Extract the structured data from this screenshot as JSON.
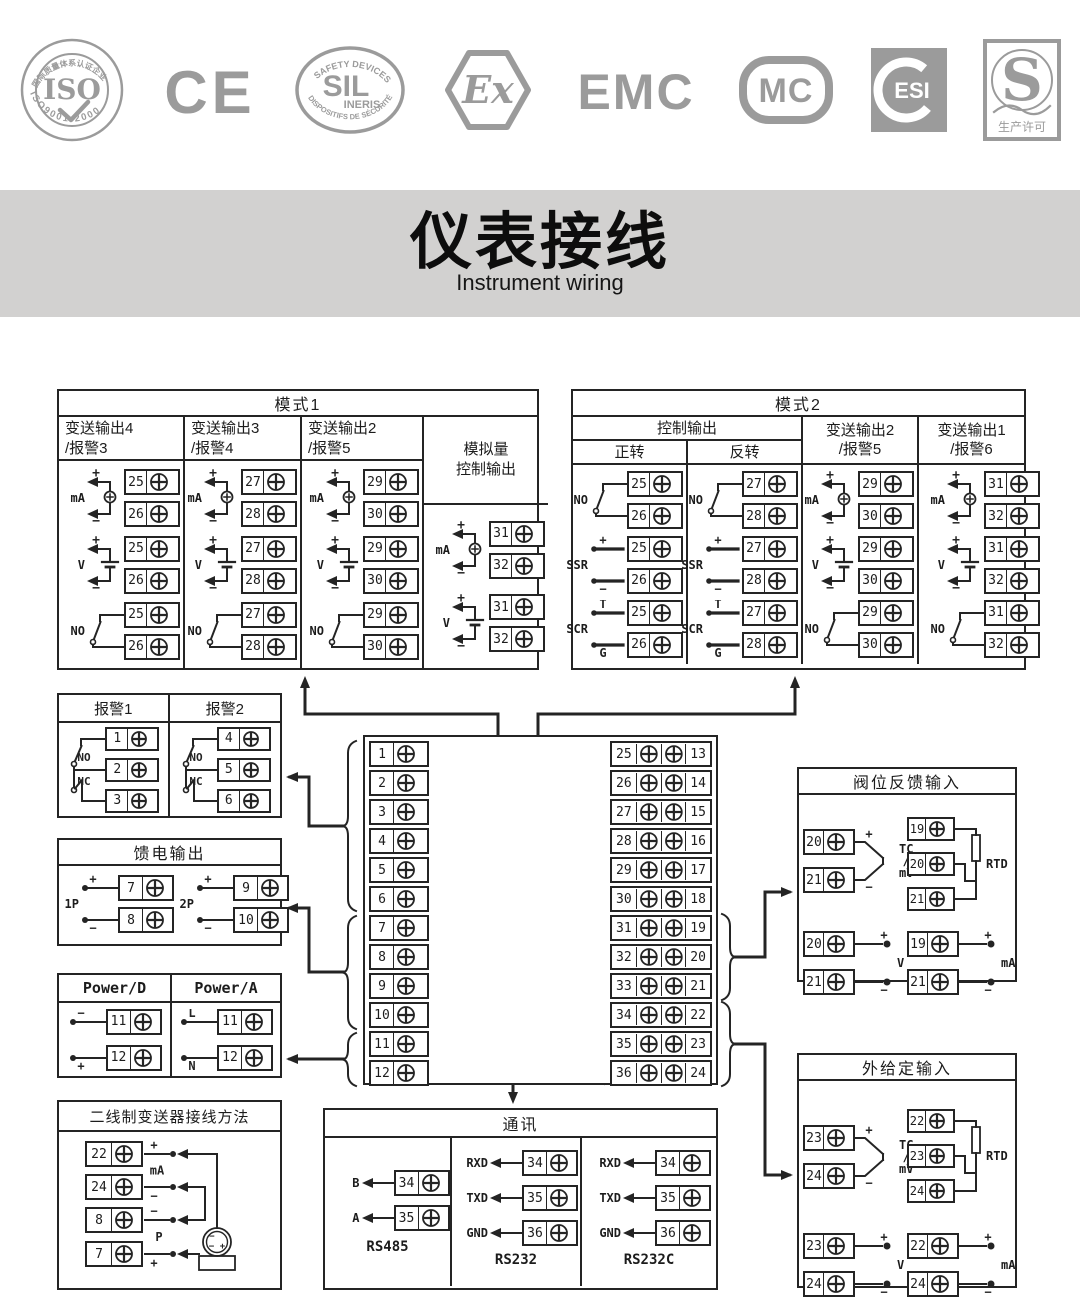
{
  "palette": {
    "ink": "#242424",
    "logo_gray": "#9b9b9b",
    "band_bg": "#d2d1d0",
    "paper": "#ffffff"
  },
  "title": {
    "zh": "仪表接线",
    "en": "Instrument wiring"
  },
  "logos": [
    {
      "type": "iso",
      "main": "ISO",
      "arc_top": "国际质量体系认证企业",
      "arc_bottom": "ISO9001:2000"
    },
    {
      "type": "ce",
      "text": "CE"
    },
    {
      "type": "sil",
      "arc_top": "SAFETY DEVICES",
      "main": "SIL",
      "sub": "INERIS",
      "arc_bottom": "DISPOSITIFS DE SÉCURITÉ"
    },
    {
      "type": "ex",
      "text": "Ex"
    },
    {
      "type": "emc",
      "text": "EMC"
    },
    {
      "type": "mc",
      "text": "MC"
    },
    {
      "type": "esi",
      "text": "ESI"
    },
    {
      "type": "s",
      "text": "S",
      "sub": "生产许可"
    }
  ],
  "boxes": {
    "mode1": {
      "title": "模式1",
      "columns": [
        {
          "header": [
            "变送输出4",
            "/报警3"
          ],
          "diagrams": [
            {
              "label": "mA",
              "type": "mA",
              "terminals": [
                25,
                26
              ]
            },
            {
              "label": "V",
              "type": "V",
              "terminals": [
                25,
                26
              ]
            },
            {
              "label": "NO",
              "type": "NO",
              "terminals": [
                25,
                26
              ]
            }
          ]
        },
        {
          "header": [
            "变送输出3",
            "/报警4"
          ],
          "diagrams": [
            {
              "label": "mA",
              "type": "mA",
              "terminals": [
                27,
                28
              ]
            },
            {
              "label": "V",
              "type": "V",
              "terminals": [
                27,
                28
              ]
            },
            {
              "label": "NO",
              "type": "NO",
              "terminals": [
                27,
                28
              ]
            }
          ]
        },
        {
          "header": [
            "变送输出2",
            "/报警5"
          ],
          "diagrams": [
            {
              "label": "mA",
              "type": "mA",
              "terminals": [
                29,
                30
              ]
            },
            {
              "label": "V",
              "type": "V",
              "terminals": [
                29,
                30
              ]
            },
            {
              "label": "NO",
              "type": "NO",
              "terminals": [
                29,
                30
              ]
            }
          ]
        },
        {
          "header": [
            "模拟量",
            "控制输出"
          ],
          "tall": true,
          "diagrams": [
            {
              "label": "mA",
              "type": "mA",
              "terminals": [
                31,
                32
              ]
            },
            {
              "label": "V",
              "type": "V",
              "terminals": [
                31,
                32
              ]
            }
          ]
        }
      ]
    },
    "mode2": {
      "title": "模式2",
      "group_header": "控制输出",
      "sub_headers": [
        "正转",
        "反转"
      ],
      "columns": [
        {
          "diagrams": [
            {
              "label": "NO",
              "type": "NO",
              "terminals": [
                25,
                26
              ]
            },
            {
              "label": "SSR",
              "type": "SSR",
              "terminals": [
                25,
                26
              ],
              "marks": [
                "+",
                "−"
              ]
            },
            {
              "label": "SCR",
              "type": "SCR",
              "terminals": [
                25,
                26
              ],
              "marks": [
                "T",
                "G"
              ]
            }
          ]
        },
        {
          "diagrams": [
            {
              "label": "NO",
              "type": "NO",
              "terminals": [
                27,
                28
              ]
            },
            {
              "label": "SSR",
              "type": "SSR",
              "terminals": [
                27,
                28
              ],
              "marks": [
                "+",
                "−"
              ]
            },
            {
              "label": "SCR",
              "type": "SCR",
              "terminals": [
                27,
                28
              ],
              "marks": [
                "T",
                "G"
              ]
            }
          ]
        },
        {
          "header": [
            "变送输出2",
            "/报警5"
          ],
          "diagrams": [
            {
              "label": "mA",
              "type": "mA",
              "terminals": [
                29,
                30
              ]
            },
            {
              "label": "V",
              "type": "V",
              "terminals": [
                29,
                30
              ]
            },
            {
              "label": "NO",
              "type": "NO",
              "terminals": [
                29,
                30
              ]
            }
          ]
        },
        {
          "header": [
            "变送输出1",
            "/报警6"
          ],
          "diagrams": [
            {
              "label": "mA",
              "type": "mA",
              "terminals": [
                31,
                32
              ]
            },
            {
              "label": "V",
              "type": "V",
              "terminals": [
                31,
                32
              ]
            },
            {
              "label": "NO",
              "type": "NO",
              "terminals": [
                31,
                32
              ]
            }
          ]
        }
      ]
    },
    "alarm": {
      "columns": [
        {
          "header": "报警1",
          "contacts": [
            "NO",
            "NC"
          ],
          "terminals": [
            1,
            2,
            3
          ]
        },
        {
          "header": "报警2",
          "contacts": [
            "NO",
            "NC"
          ],
          "terminals": [
            4,
            5,
            6
          ]
        }
      ]
    },
    "feed": {
      "title": "馈电输出",
      "groups": [
        {
          "label": "1P",
          "signs": [
            "+",
            "−"
          ],
          "terminals": [
            7,
            8
          ]
        },
        {
          "label": "2P",
          "signs": [
            "+",
            "−"
          ],
          "terminals": [
            9,
            10
          ]
        }
      ]
    },
    "power": {
      "columns": [
        {
          "header": "Power/D",
          "signs": [
            "−",
            "+"
          ],
          "terminals": [
            11,
            12
          ]
        },
        {
          "header": "Power/A",
          "signs": [
            "L",
            "N"
          ],
          "terminals": [
            11,
            12
          ]
        }
      ]
    },
    "twowire": {
      "title": "二线制变送器接线方法",
      "rows": [
        {
          "terminal": 22,
          "sign": "+",
          "pos": "above"
        },
        {
          "terminal": 24,
          "sign": "−",
          "pos": "below"
        },
        {
          "terminal": 8,
          "sign": "−",
          "pos": "above"
        },
        {
          "terminal": 7,
          "sign": "+",
          "pos": "below"
        }
      ],
      "mid_labels": [
        "mA",
        "P"
      ],
      "transmitter_marks": [
        "−",
        "− +"
      ]
    },
    "terminal_block": {
      "left": [
        1,
        2,
        3,
        4,
        5,
        6,
        7,
        8,
        9,
        10,
        11,
        12
      ],
      "right_outer": [
        25,
        26,
        27,
        28,
        29,
        30,
        31,
        32,
        33,
        34,
        35,
        36
      ],
      "right_inner": [
        13,
        14,
        15,
        16,
        17,
        18,
        19,
        20,
        21,
        22,
        23,
        24
      ]
    },
    "valve": {
      "title": "阀位反馈输入",
      "groups": [
        {
          "kind": "tc",
          "terminals": [
            20,
            21
          ],
          "signs": [
            "+",
            "−"
          ],
          "label_lines": [
            "TC",
            "/",
            "mV"
          ]
        },
        {
          "kind": "rtd",
          "terminals": [
            19,
            20,
            21
          ],
          "label": "RTD"
        },
        {
          "kind": "dot",
          "terminals": [
            20,
            21
          ],
          "signs": [
            "+",
            "−"
          ],
          "label": "V"
        },
        {
          "kind": "dot",
          "terminals": [
            19,
            21
          ],
          "signs": [
            "+",
            "−"
          ],
          "label": "mA"
        }
      ]
    },
    "external": {
      "title": "外给定输入",
      "groups": [
        {
          "kind": "tc",
          "terminals": [
            23,
            24
          ],
          "signs": [
            "+",
            "−"
          ],
          "label_lines": [
            "TC",
            "/",
            "mV"
          ]
        },
        {
          "kind": "rtd",
          "terminals": [
            22,
            23,
            24
          ],
          "label": "RTD"
        },
        {
          "kind": "dot",
          "terminals": [
            23,
            24
          ],
          "signs": [
            "+",
            "−"
          ],
          "label": "V"
        },
        {
          "kind": "dot",
          "terminals": [
            22,
            24
          ],
          "signs": [
            "+",
            "−"
          ],
          "label": "mA"
        }
      ]
    },
    "comm": {
      "title": "通讯",
      "sections": [
        {
          "name": "RS485",
          "rows": [
            {
              "label": "B",
              "terminal": 34
            },
            {
              "label": "A",
              "terminal": 35
            }
          ]
        },
        {
          "name": "RS232",
          "rows": [
            {
              "label": "RXD",
              "terminal": 34
            },
            {
              "label": "TXD",
              "terminal": 35
            },
            {
              "label": "GND",
              "terminal": 36
            }
          ]
        },
        {
          "name": "RS232C",
          "rows": [
            {
              "label": "RXD",
              "terminal": 34
            },
            {
              "label": "TXD",
              "terminal": 35
            },
            {
              "label": "GND",
              "terminal": 36
            }
          ]
        }
      ]
    }
  }
}
